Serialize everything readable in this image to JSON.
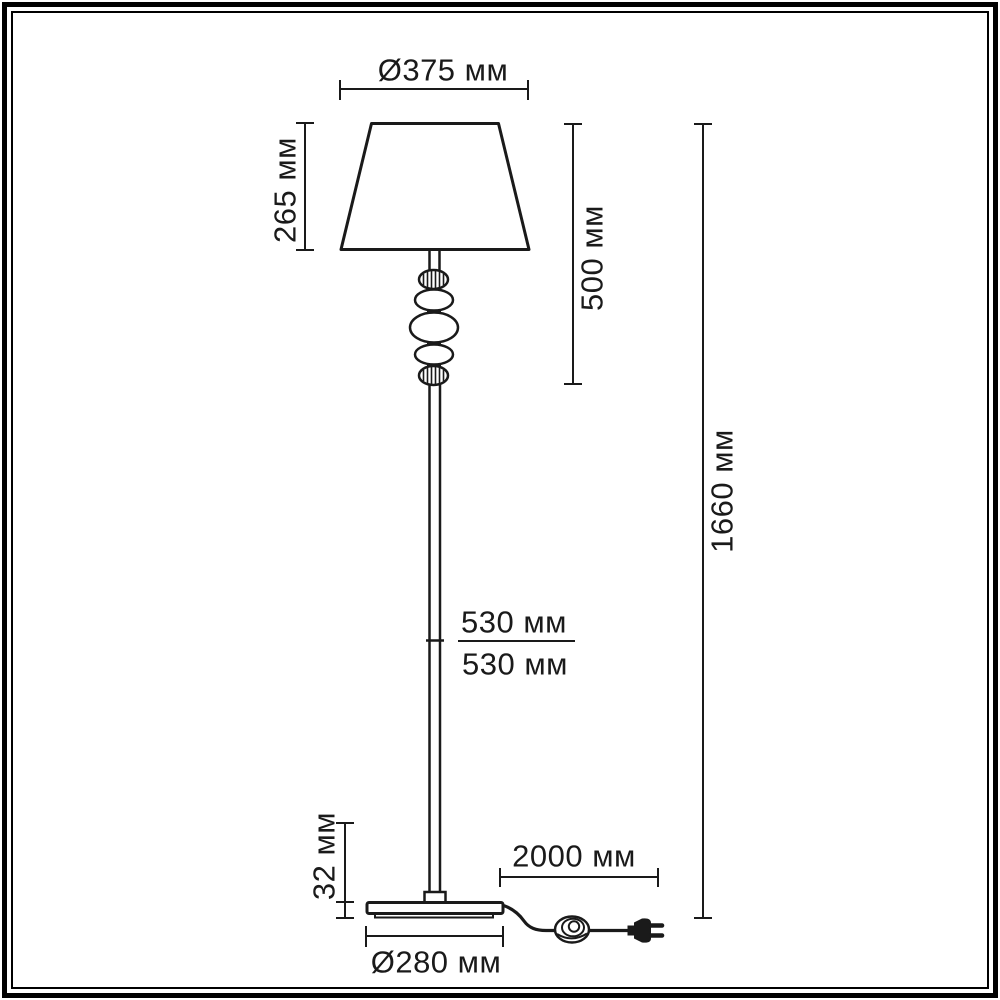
{
  "page": {
    "background": "#ffffff",
    "ink": "#1a1a1a",
    "subject": "floor-lamp-dimensional-drawing"
  },
  "drawing": {
    "unit": "мм",
    "labels": {
      "shade_diameter": "Ø375 мм",
      "shade_height": "265 мм",
      "upper_assembly_height": "500 мм",
      "total_height": "1660 мм",
      "upper_pole_length": "530 мм",
      "lower_pole_length": "530 мм",
      "base_thickness": "32 мм",
      "cord_length": "2000 мм",
      "base_diameter": "Ø280 мм"
    }
  }
}
